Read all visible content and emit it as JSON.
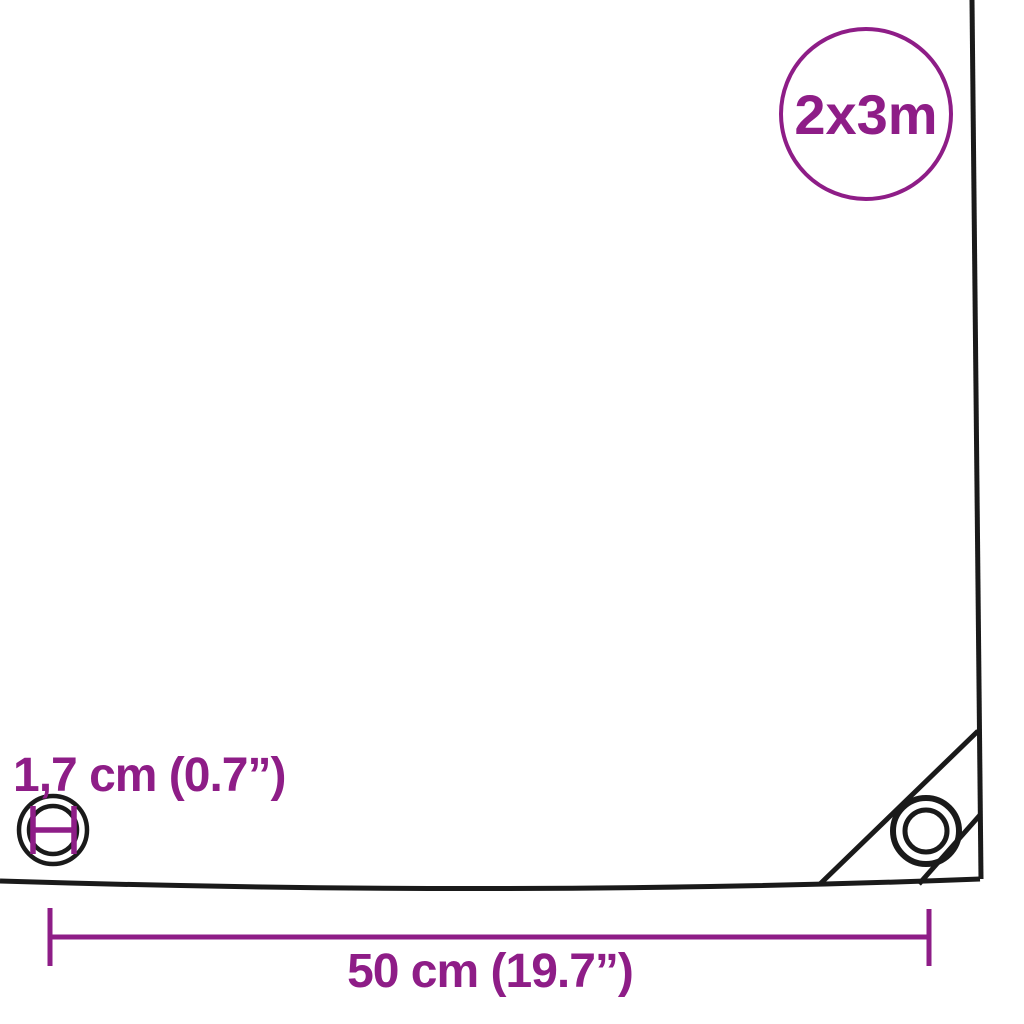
{
  "colors": {
    "accent": "#8e1d87",
    "line": "#1a1a1a",
    "background": "#ffffff"
  },
  "badge": {
    "label": "2x3m"
  },
  "labels": {
    "eyelet_diameter": "1,7 cm (0.7”)",
    "bottom_width": "50 cm (19.7”)"
  },
  "icons": {
    "eyelet_measure": "eyelet-diameter-icon",
    "corner_grommet": "corner-grommet-icon"
  }
}
